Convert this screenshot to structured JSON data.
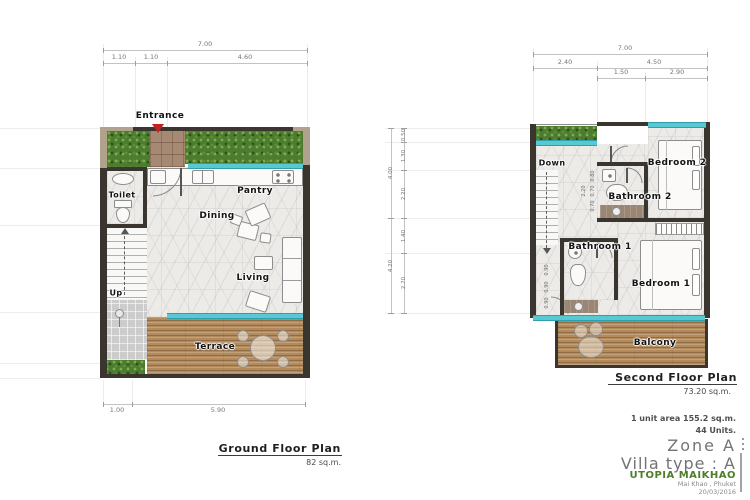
{
  "ground_floor": {
    "title": "Ground Floor Plan",
    "area": "82 sq.m.",
    "dims": {
      "total_width": "7.00",
      "top_segments": [
        "1.10",
        "1.10",
        "4.60"
      ],
      "bottom_segments": [
        "1.00",
        "5.90"
      ]
    },
    "labels": {
      "entrance": "Entrance",
      "toilet": "Toilet",
      "pantry": "Pantry",
      "dining": "Dining",
      "living": "Living",
      "up": "Up",
      "terrace": "Terrace"
    }
  },
  "second_floor": {
    "title": "Second Floor Plan",
    "area": "73.20 sq.m.",
    "dims": {
      "total_width": "7.00",
      "top_segments": [
        "2.40",
        "4.50"
      ],
      "top_sub_segments": [
        "1.50",
        "2.90"
      ],
      "left_outer": [
        "4.00",
        "4.20"
      ],
      "left_inner": [
        "0.50",
        "1.30",
        "2.20",
        "1.40",
        "2.70"
      ],
      "stair_chain_total": "2.20",
      "stair_chain": [
        "0.80",
        "0.70",
        "0.70"
      ],
      "bath1_chain": [
        "0.90",
        "0.90",
        "0.90"
      ]
    },
    "labels": {
      "down": "Down",
      "bedroom2": "Bedroom 2",
      "bathroom2": "Bathroom 2",
      "bathroom1": "Bathroom 1",
      "bedroom1": "Bedroom 1",
      "balcony": "Balcony"
    }
  },
  "title_block": {
    "unit_area": "1 unit area 155.2 sq.m.",
    "units": "44 Units.",
    "zone": "Zone A",
    "villa_type": "Villa  type : A",
    "project": "UTOPIA MAIKHAO",
    "location": "Mai Khao , Phuket",
    "date": "20/03/2016"
  },
  "colors": {
    "wall_dark": "#3a352e",
    "wall_tan": "#b1a28d",
    "grass_green": "#4c7c2f",
    "wood_brown": "#b38a5c",
    "glass_teal": "#58c8d3",
    "entrance_red": "#c32222",
    "brand_green": "#4c7f26"
  }
}
